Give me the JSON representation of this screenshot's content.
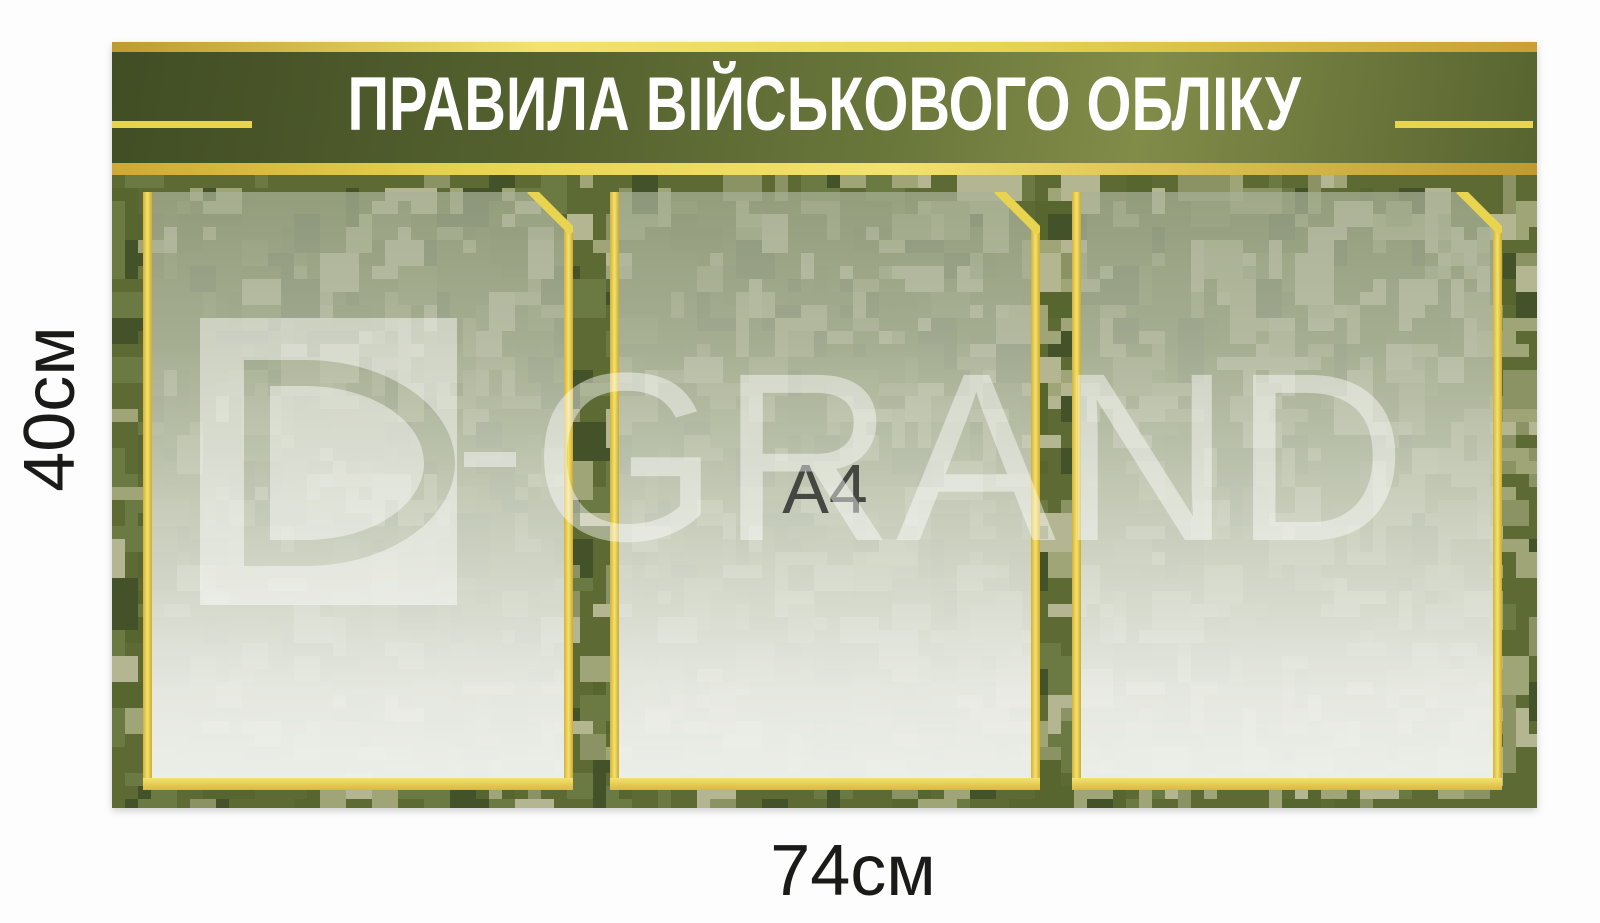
{
  "header": {
    "title": "ПРАВИЛА ВІЙСЬКОВОГО ОБЛІКУ"
  },
  "pockets": [
    {
      "label": ""
    },
    {
      "label": "A4"
    },
    {
      "label": ""
    }
  ],
  "dimensions": {
    "height_label": "40см",
    "width_label": "74см"
  },
  "watermark": {
    "brand": "D-GRAND",
    "text_part": "GRAND",
    "logo_icon": "d-grand-logo-icon"
  },
  "colors": {
    "gold": "#e8d44f",
    "gold_bright": "#f3e26c",
    "gold_dark": "#c09a2e",
    "header_green_dark": "#414d24",
    "header_green_mid": "#55622f",
    "header_green_light": "#828c49",
    "camo_base": "#5d6a33",
    "camo_palette": [
      "#44522a",
      "#57652f",
      "#6b7942",
      "#8b9263",
      "#a0a578",
      "#b4b691"
    ],
    "title_text": "#ffffff",
    "dimension_text": "#1a1a18",
    "a4_text": "#3a3c38"
  }
}
